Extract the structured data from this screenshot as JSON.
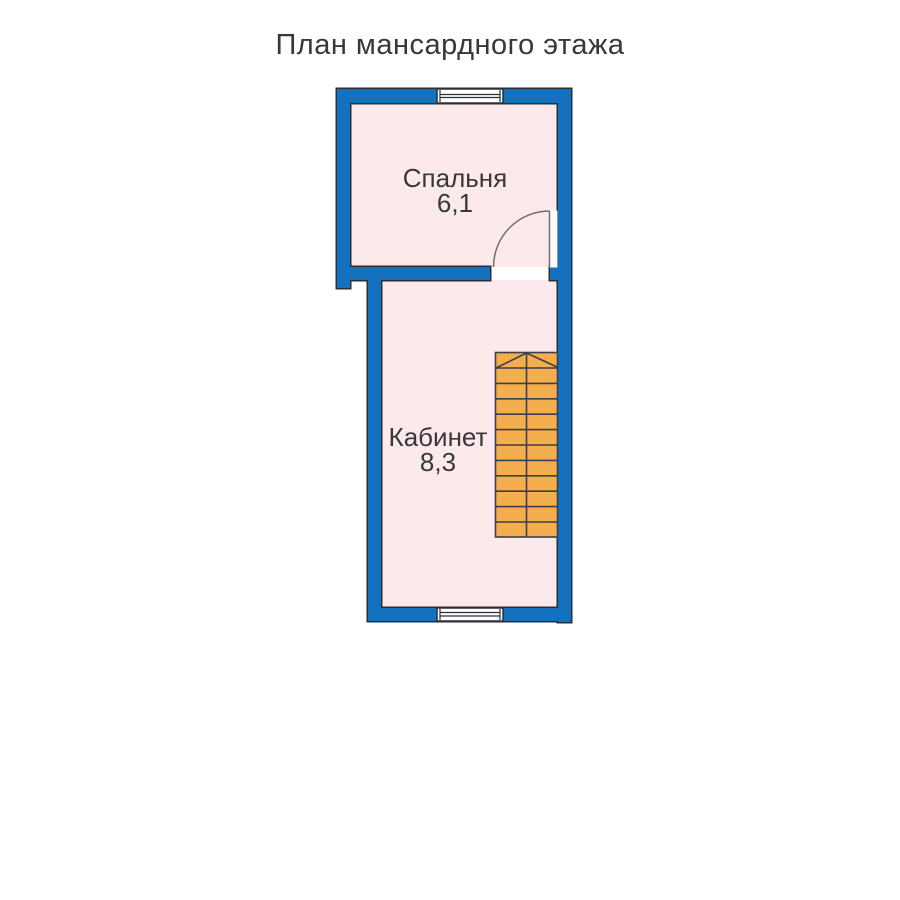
{
  "title": "План мансардного этажа",
  "colors": {
    "background": "#ffffff",
    "wall": "#1471be",
    "wall_outline": "#2b2e36",
    "room_fill": "#fbe9ec",
    "stair_fill": "#f4ae4e",
    "stair_line": "#3a3f4a",
    "door_line": "#6f6f6f",
    "window_fill": "#ffffff",
    "text": "#383838"
  },
  "rooms": [
    {
      "name": "Спальня",
      "area": "6,1"
    },
    {
      "name": "Кабинет",
      "area": "8,3"
    }
  ],
  "features": {
    "windows_count": 2,
    "door_count": 1,
    "staircase": {
      "treads": 12,
      "columns": 2,
      "direction_marker": "chevron-up"
    }
  }
}
